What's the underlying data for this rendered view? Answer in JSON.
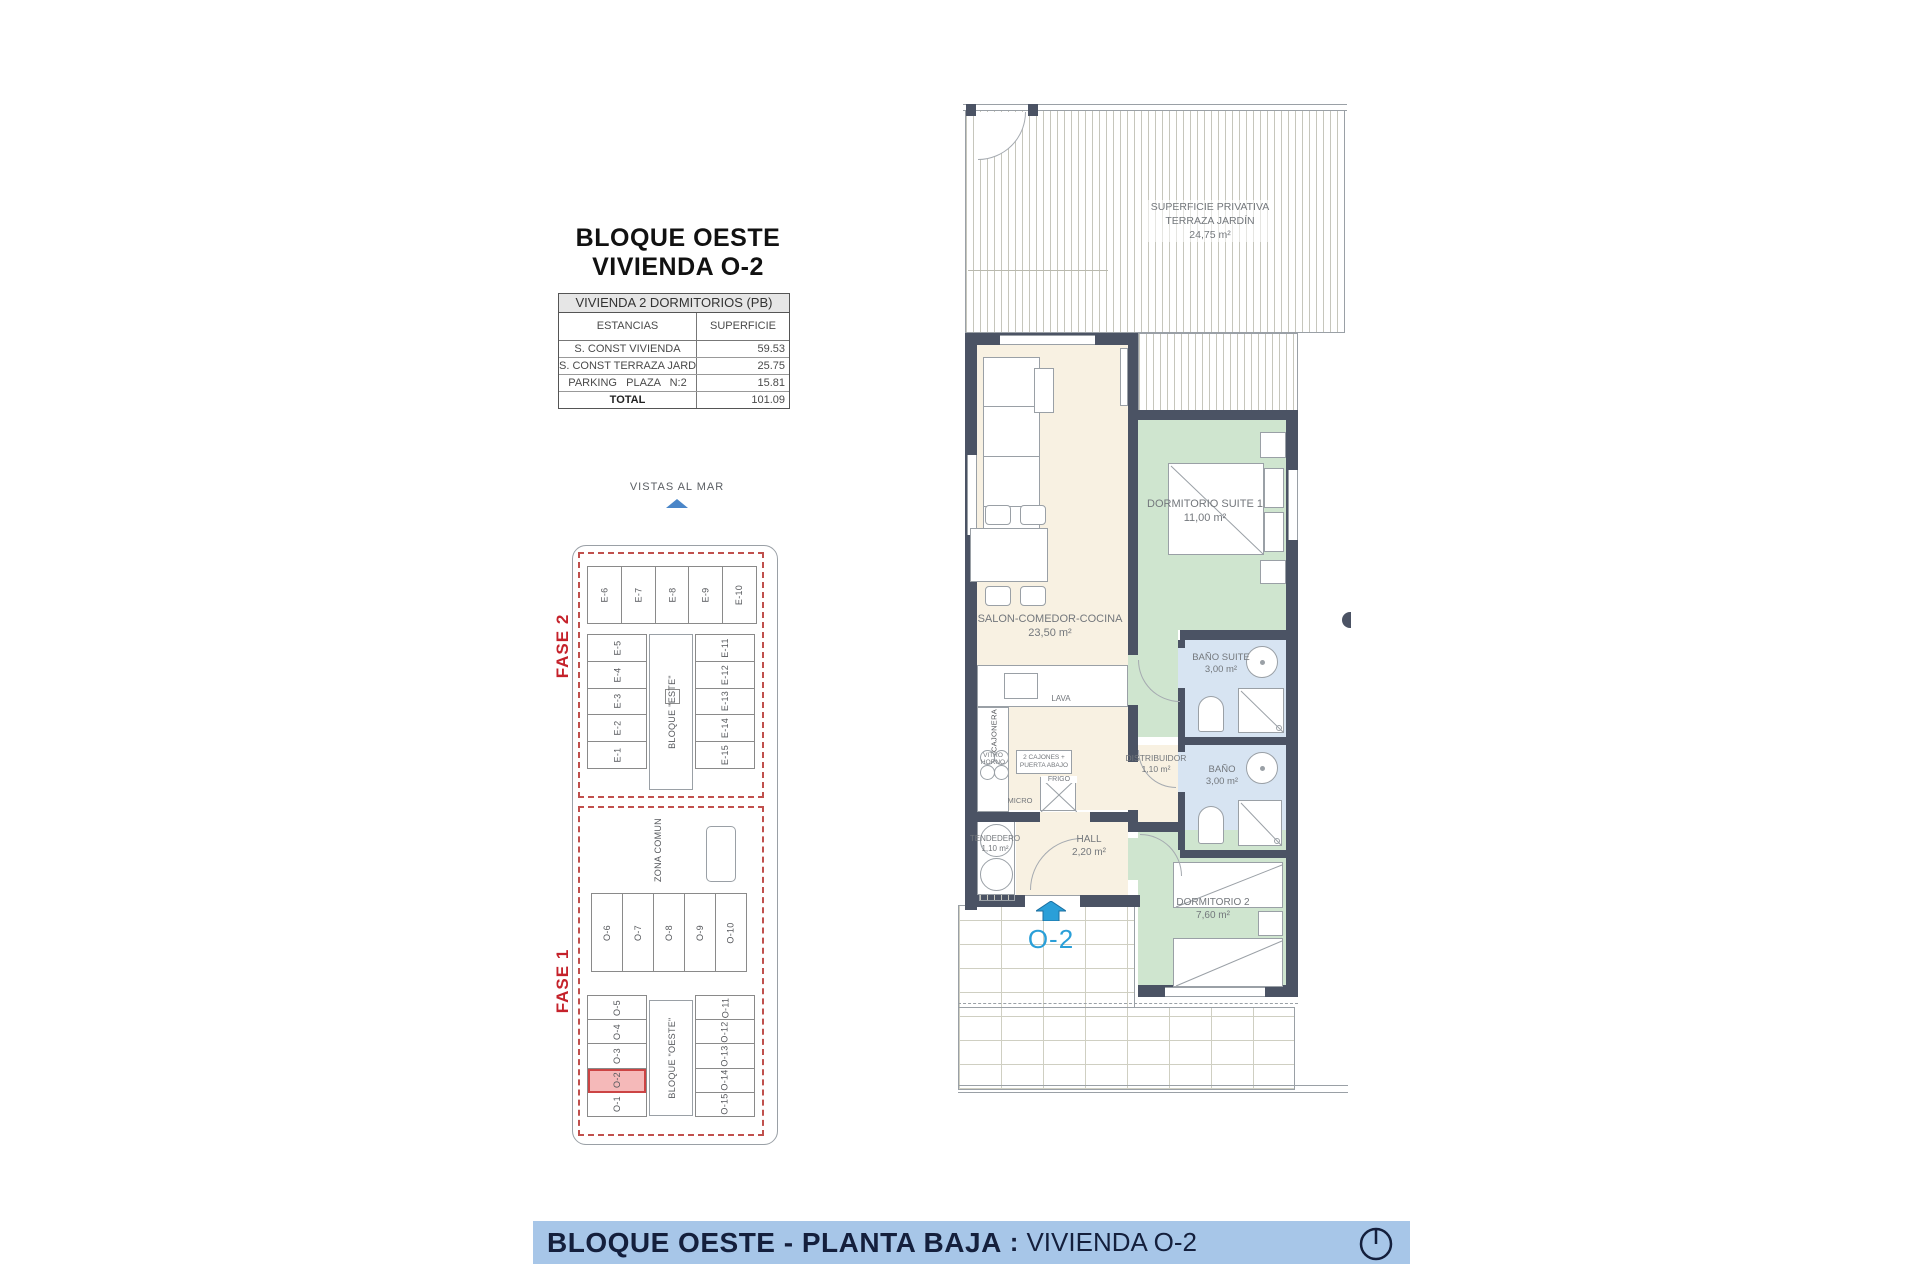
{
  "title": {
    "line1": "BLOQUE OESTE",
    "line2": "VIVIENDA O-2"
  },
  "area_table": {
    "header": "VIVIENDA 2 DORMITORIOS (PB)",
    "col_estancias": "ESTANCIAS",
    "col_superficie": "SUPERFICIE",
    "rows": [
      {
        "label": "S. CONST VIVIENDA",
        "value": "59.53"
      },
      {
        "label": "S. CONST TERRAZA JARDÍN",
        "value": "25.75"
      },
      {
        "label": "PARKING   PLAZA   N:2",
        "value": "15.81"
      },
      {
        "label": "TOTAL",
        "value": "101.09"
      }
    ]
  },
  "site_plan": {
    "vistas_al_mar": "VISTAS AL MAR",
    "fase_2": "FASE 2",
    "fase_1": "FASE 1",
    "bloque_este": "BLOQUE \"ESTE\"",
    "bloque_oeste": "BLOQUE \"OESTE\"",
    "zona_comun": "ZONA COMUN",
    "highlighted_unit": "O-2",
    "este_top": [
      "E-6",
      "E-7",
      "E-8",
      "E-9",
      "E-10"
    ],
    "este_left": [
      "E-5",
      "E-4",
      "E-3",
      "E-2",
      "E-1"
    ],
    "este_right": [
      "E-11",
      "E-12",
      "E-13",
      "E-14",
      "E-15"
    ],
    "oeste_mid": [
      "O-6",
      "O-7",
      "O-8",
      "O-9",
      "O-10"
    ],
    "oeste_left": [
      "O-5",
      "O-4",
      "O-3",
      "O-2",
      "O-1"
    ],
    "oeste_right": [
      "O-11",
      "O-12",
      "O-13",
      "O-14",
      "O-15"
    ]
  },
  "floor_plan": {
    "rooms": {
      "terraza": {
        "name": "SUPERFICIE PRIVATIVA TERRAZA JARDÍN",
        "area": "24,75 m²"
      },
      "salon": {
        "name": "SALON-COMEDOR-COCINA",
        "area": "23,50 m²"
      },
      "dormitorio_suite": {
        "name": "DORMITORIO SUITE 1",
        "area": "11,00 m²"
      },
      "bano_suite": {
        "name": "BAÑO SUITE",
        "area": "3,00 m²"
      },
      "bano": {
        "name": "BAÑO",
        "area": "3,00 m²"
      },
      "distribuidor": {
        "name": "DISTRIBUIDOR",
        "area": "1,10 m²"
      },
      "hall": {
        "name": "HALL",
        "area": "2,20 m²"
      },
      "tendedero": {
        "name": "TENDEDERO",
        "area": "1,10 m²"
      },
      "dormitorio_2": {
        "name": "DORMITORIO 2",
        "area": "7,60 m²"
      }
    },
    "kitchen": {
      "lava": "LAVA",
      "cajonera": "CAJONERA",
      "vitro": "VITRO HORNO",
      "cajones": "2 CAJONES + PUERTA ABAJO",
      "frigo": "FRIGO",
      "micro": "MICRO"
    },
    "unit_label": "O-2"
  },
  "footer": {
    "title_bold": "BLOQUE OESTE - PLANTA BAJA",
    "separator": ":",
    "title_regular": "VIVIENDA O-2"
  },
  "colors": {
    "wall": "#4b5364",
    "living": "#f8f1e2",
    "bedroom": "#cfe5cf",
    "bathroom": "#d7e4f2",
    "highlight_fill": "#f5b9b9",
    "highlight_border": "#cc4444",
    "fase_red": "#c5222b",
    "footer_bg": "#a7c6e8",
    "footer_text": "#141f3c",
    "unit_blue": "#2a9fd8"
  }
}
